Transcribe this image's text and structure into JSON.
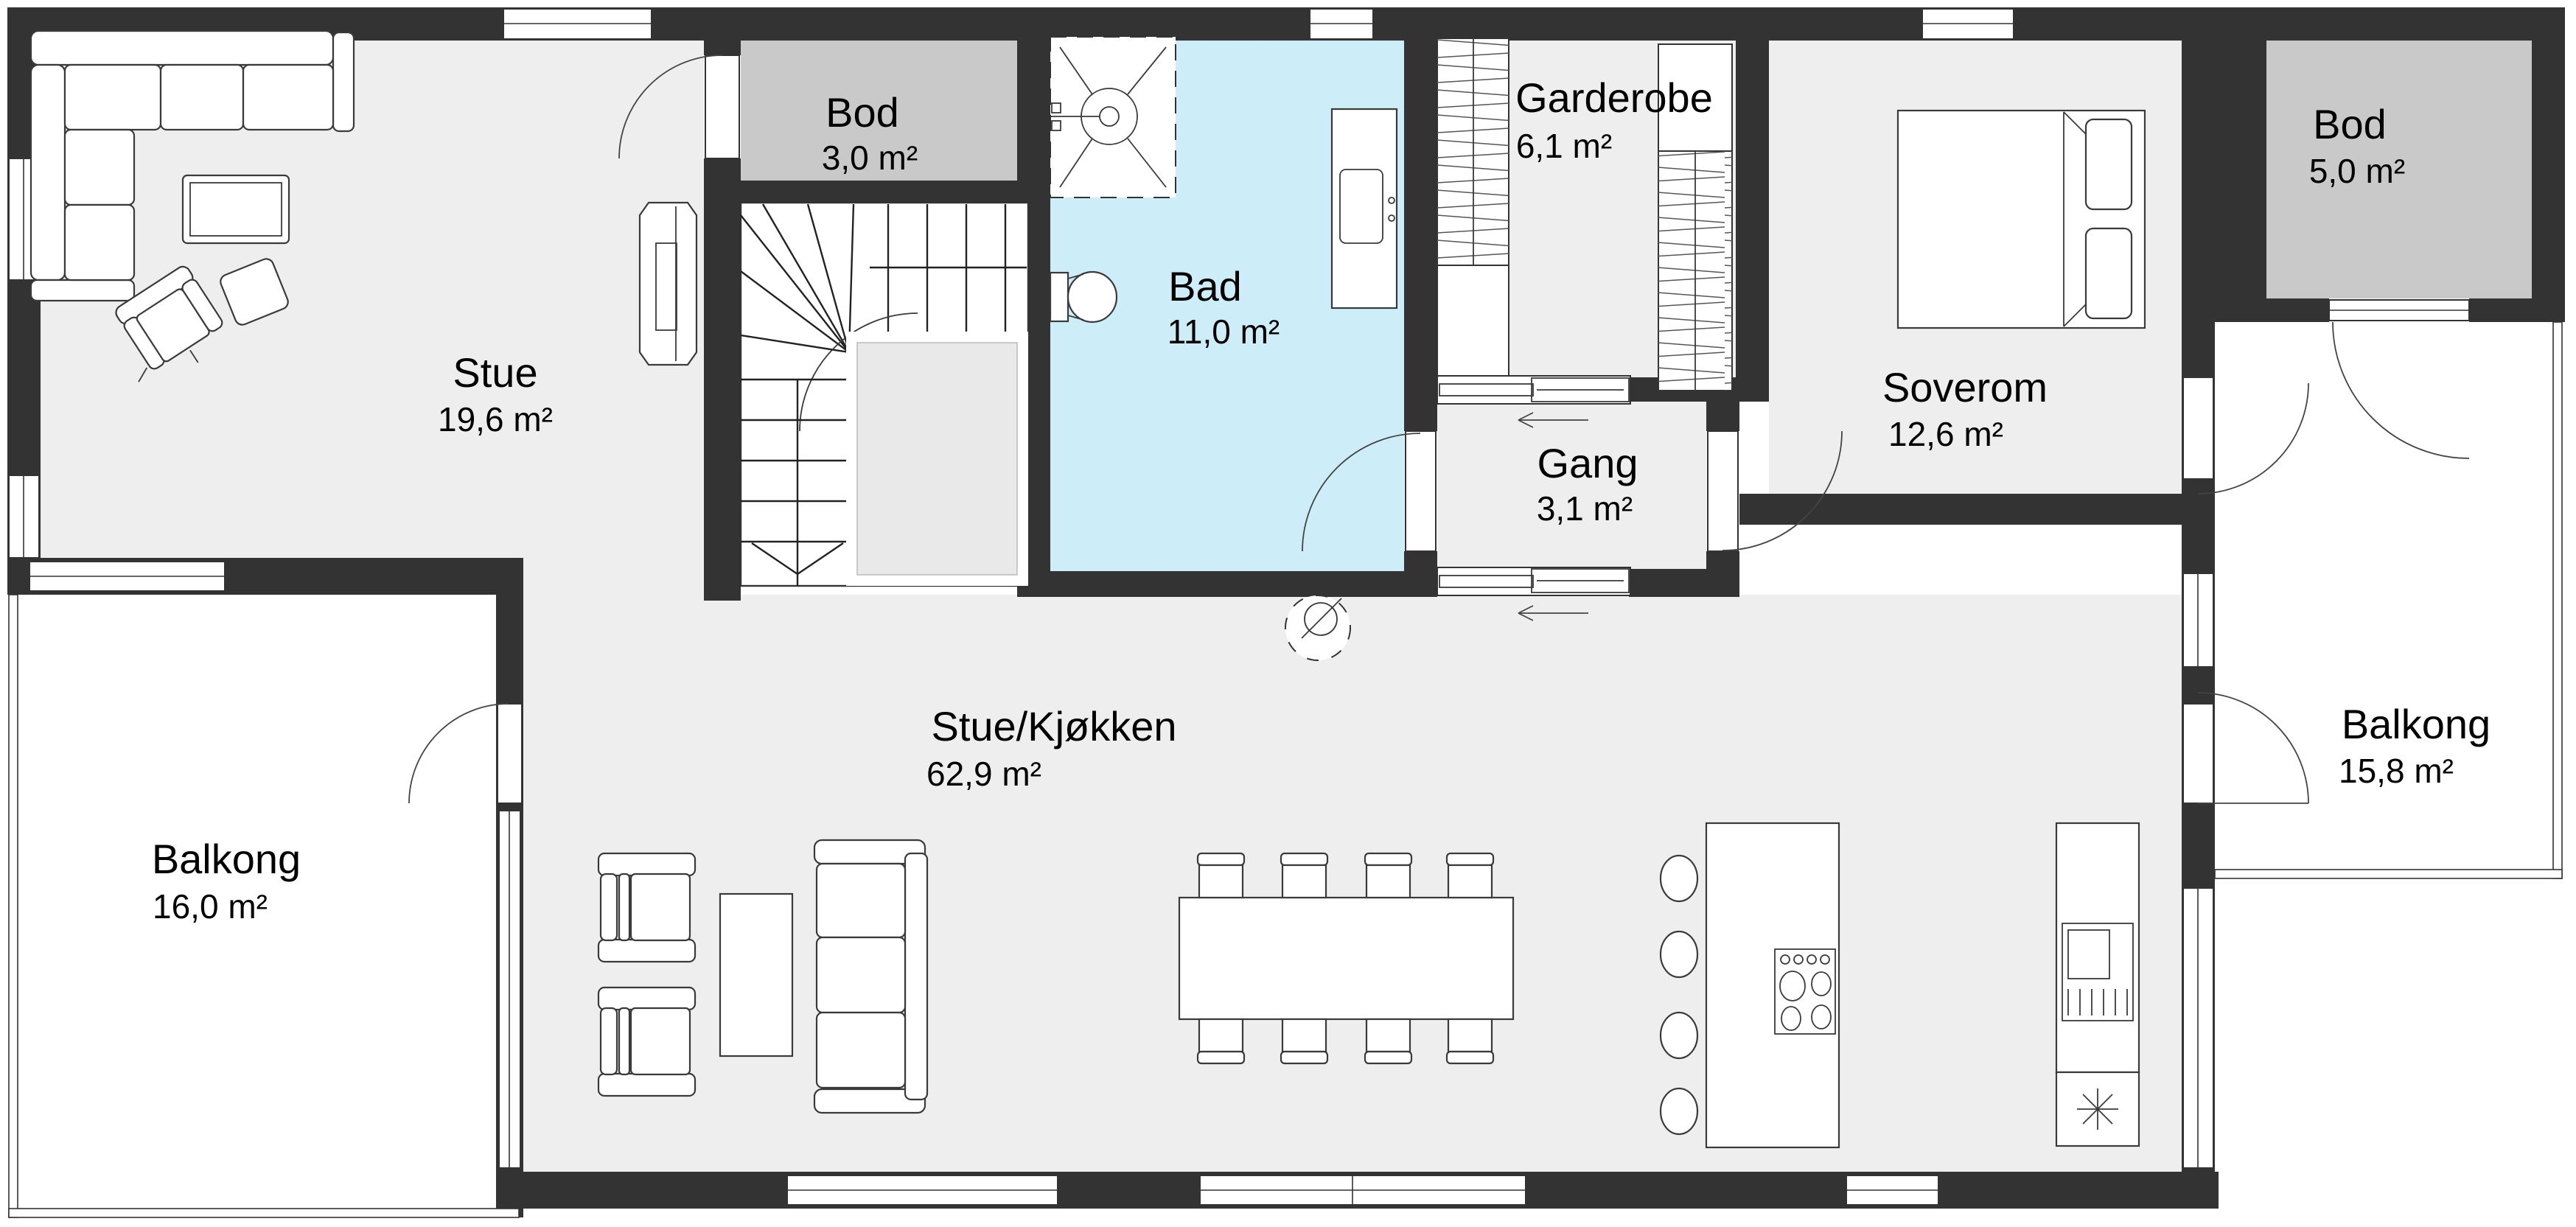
{
  "plan": {
    "type": "floor-plan",
    "language": "Norwegian",
    "colors": {
      "wall": "#333333",
      "floor": "#eeeeee",
      "storage_room": "#c9c9c9",
      "bathroom": "#cdeef8",
      "outside": "#ffffff"
    }
  },
  "rooms": [
    {
      "id": "stue",
      "name": "Stue",
      "area": "19,6 m²"
    },
    {
      "id": "bod-small",
      "name": "Bod",
      "area": "3,0 m²"
    },
    {
      "id": "bad",
      "name": "Bad",
      "area": "11,0 m²"
    },
    {
      "id": "garderobe",
      "name": "Garderobe",
      "area": "6,1 m²"
    },
    {
      "id": "soverom",
      "name": "Soverom",
      "area": "12,6 m²"
    },
    {
      "id": "bod-large",
      "name": "Bod",
      "area": "5,0 m²"
    },
    {
      "id": "gang",
      "name": "Gang",
      "area": "3,1 m²"
    },
    {
      "id": "stue-kjokken",
      "name": "Stue/Kjøkken",
      "area": "62,9 m²"
    },
    {
      "id": "balkong-left",
      "name": "Balkong",
      "area": "16,0 m²"
    },
    {
      "id": "balkong-right",
      "name": "Balkong",
      "area": "15,8 m²"
    }
  ]
}
